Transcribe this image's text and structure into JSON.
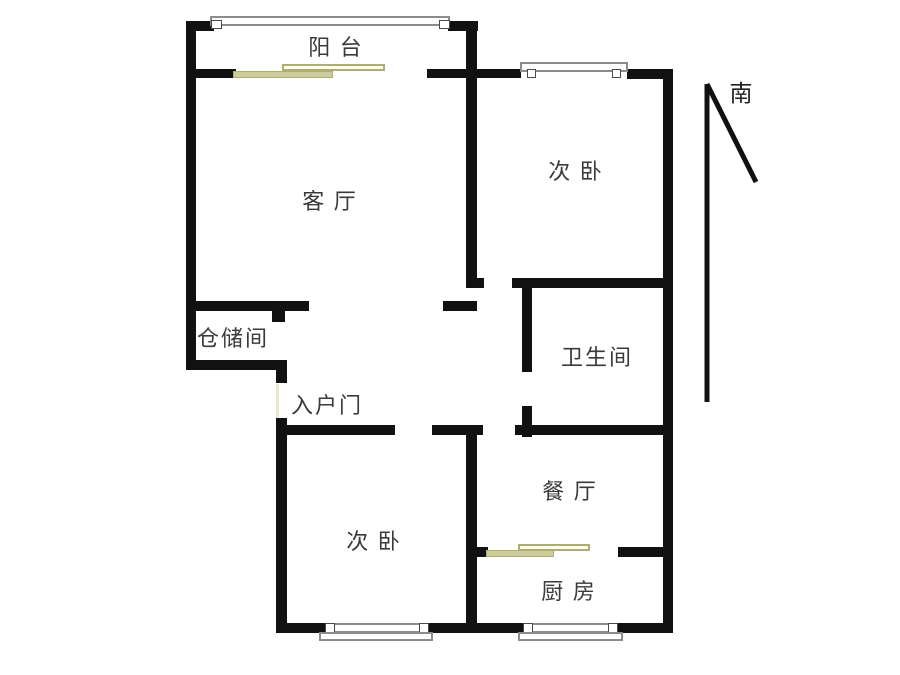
{
  "colors": {
    "wall": "#111111",
    "label": "#3a3a3a",
    "winframe": "#8c8c8c",
    "slider": "#cdcd9b",
    "sliderBorder": "#aeae72"
  },
  "compass": {
    "label": "南"
  },
  "rooms": [
    {
      "id": "balcony",
      "label": "阳 台"
    },
    {
      "id": "living-room",
      "label": "客 厅"
    },
    {
      "id": "bedroom-top",
      "label": "次 卧"
    },
    {
      "id": "storage",
      "label": "仓储间"
    },
    {
      "id": "entry-door",
      "label": "入户门"
    },
    {
      "id": "bathroom",
      "label": "卫生间"
    },
    {
      "id": "dining-room",
      "label": "餐 厅"
    },
    {
      "id": "bedroom-bottom",
      "label": "次 卧"
    },
    {
      "id": "kitchen",
      "label": "厨 房"
    }
  ]
}
